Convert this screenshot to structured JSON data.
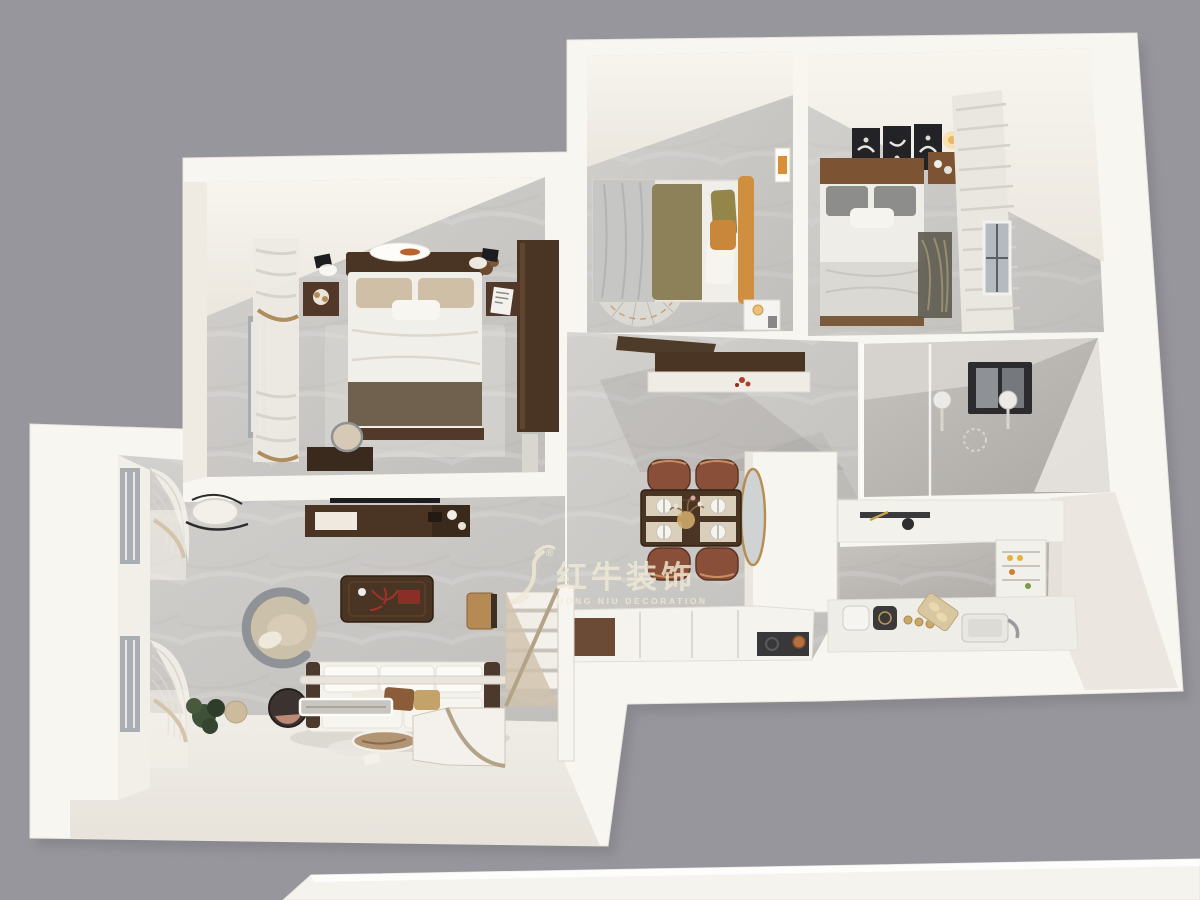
{
  "watermark": {
    "logo_icon": "bull-logo-icon",
    "registered_mark": "®",
    "title_cn": "红牛装饰",
    "subtitle_en": "HONG NIU DECORATION",
    "color": "#f0e9d4"
  },
  "palette": {
    "background": "#97969c",
    "plan_white": "#f8f6f1",
    "wall_lit": "#f3f0ea",
    "floor_marble": "#c7c5c2",
    "floor_cream": "#eeebe5",
    "wood_dark": "#4a3423",
    "wood_mid": "#7c5434",
    "chair_brown": "#8a4f38",
    "accent_orange": "#cf8f3e",
    "tile_gray": "#bcb9b5",
    "watermark_cream": "#f0e9d4"
  }
}
